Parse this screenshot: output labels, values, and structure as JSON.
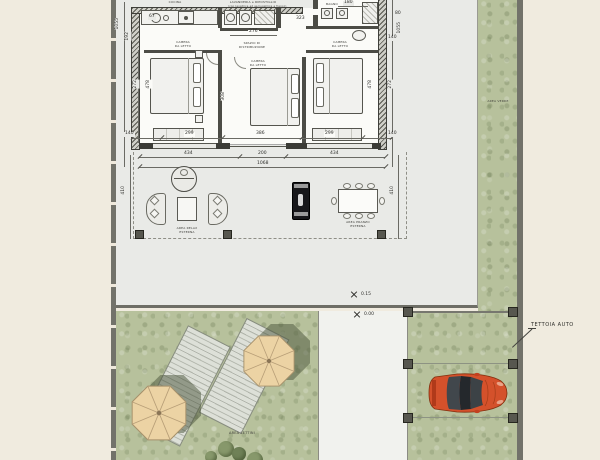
{
  "building": {
    "labels": {
      "kitchen": "CUCINA",
      "laundry1": "LAVANDERIA e RIPOSTIGLIO",
      "laundry2": "(con lavatrice ed asciugatrice a fianco)",
      "bath": "BAGNO",
      "hall1": "SPAZIO DI",
      "hall2": "DISTRIBUZIONE",
      "bedroom1": "CAMERA",
      "bedroom2": "DA LETTO"
    },
    "dims": {
      "d67": "67",
      "d276": "276",
      "d323": "323",
      "d180": "180",
      "d80": "80",
      "d1055": "1055",
      "d192": "192",
      "d272": "272",
      "d478": "478",
      "d140": "140",
      "d299": "299",
      "d386": "386",
      "d308": "308",
      "d434": "434",
      "d200": "200",
      "d1068": "1068",
      "d410": "410"
    }
  },
  "terrace": {
    "relax1": "AREA RELAX",
    "relax2": "ESTERNA",
    "dining1": "AREA PRANZO",
    "dining2": "ESTERNA"
  },
  "levels": {
    "upper": "0.15",
    "lower": "0.00"
  },
  "garden": {
    "loungers": "AREA LETTINI",
    "green": "AREA VERDE"
  },
  "carport": {
    "label": "TETTOIA AUTO"
  },
  "colors": {
    "paper": "#f0ebdf",
    "terrace": "#e9eae7",
    "grass": "#b7c19c",
    "wall": "#72726a",
    "car_body": "#d4512b",
    "umbrella": "#ecd3a4"
  }
}
